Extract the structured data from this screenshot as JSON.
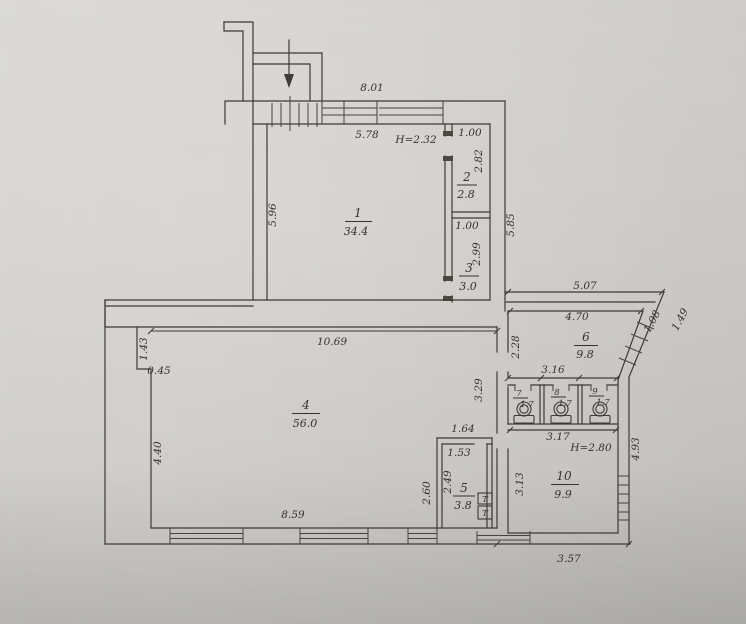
{
  "plan": {
    "rooms": [
      {
        "number": "1",
        "area": "34.4",
        "height_note": "H=2.32"
      },
      {
        "number": "2",
        "area": "2.8"
      },
      {
        "number": "3",
        "area": "3.0"
      },
      {
        "number": "4",
        "area": "56.0"
      },
      {
        "number": "5",
        "area": "3.8"
      },
      {
        "number": "6",
        "area": "9.8"
      },
      {
        "number": "7",
        "area": "1.7"
      },
      {
        "number": "8",
        "area": "1.7"
      },
      {
        "number": "9",
        "area": "1.7"
      },
      {
        "number": "10",
        "area": "9.9",
        "height_note": "H=2.80"
      }
    ],
    "dims": {
      "top_width": "8.01",
      "room1_width": "5.78",
      "closet2_width": "1.00",
      "closet2_depth": "2.82",
      "closet3_width": "1.00",
      "closet3_depth": "2.99",
      "right_side_height": "5.85",
      "room1_depth": "5.96",
      "room4_width": "10.69",
      "left_step_upper": "1.43",
      "left_step_width": "0.45",
      "left_lower": "4.40",
      "bottom_left_width": "8.59",
      "room6_outer_width": "5.07",
      "room6_inner_width": "4.70",
      "diag_inner": "1.08",
      "diag_outer": "1.49",
      "room6_left_height": "2.28",
      "stalls_width": "3.16",
      "partition_height": "3.29",
      "room10_width": "3.17",
      "room10_right_height": "4.93",
      "room10_left_height": "3.13",
      "bottom_right_width": "3.57",
      "room5_outer_width": "1.64",
      "room5_inner_width": "1.53",
      "room5_inner_height": "2.49",
      "room5_outer_height": "2.60"
    },
    "fixtures": {
      "tank_label": "T"
    }
  }
}
